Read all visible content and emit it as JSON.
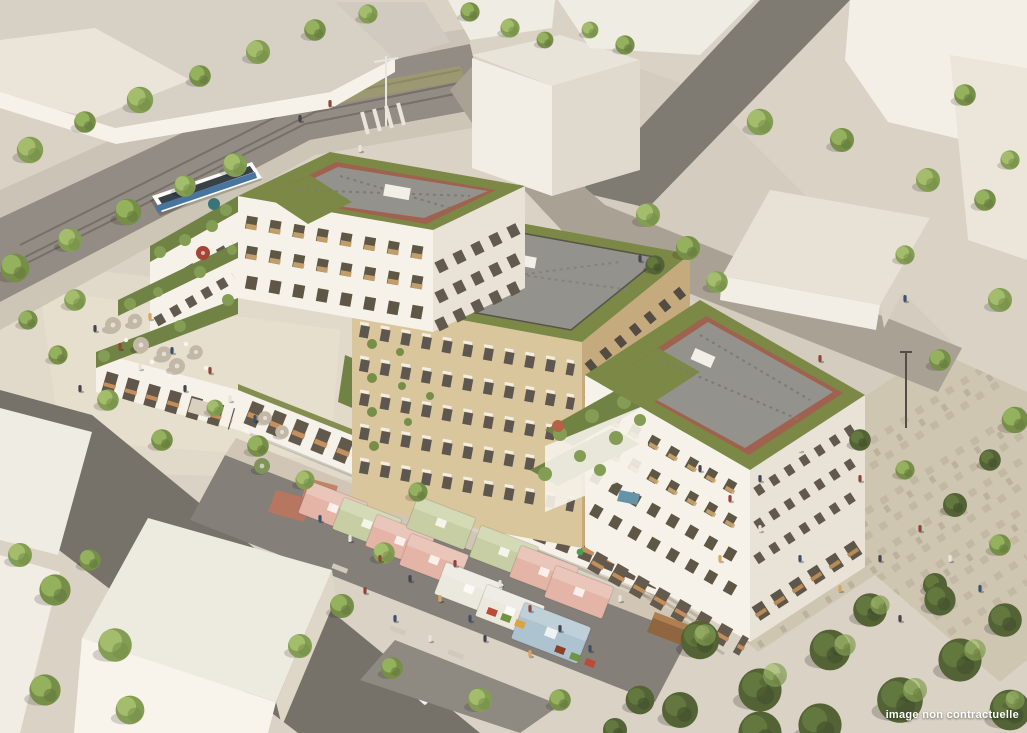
{
  "caption": {
    "text": "image non contractuelle"
  },
  "scene": {
    "description": "Aerial architectural rendering of a residential block with green roofs, rooftop terraces, a tram street, a covered market with pastel canopies, cafe terraces and pedestrian plazas lined with trees.",
    "elements": [
      "context buildings",
      "tram street with tram",
      "white residential building",
      "beige residential building",
      "green roofs with gravel decks",
      "planted courtyard garden",
      "market stall canopies",
      "cafe terrace umbrellas",
      "stone pedestrian plaza",
      "street trees",
      "dense foliage"
    ]
  },
  "colors": {
    "ground": "#d8d1c5",
    "plaza_light": "#e2dbcc",
    "plaza_stone": "#cdc4b2",
    "plaza_stripe": "#c0b6a2",
    "asphalt": "#6f6b65",
    "street_tram": "#8d8781",
    "street_ne": "#a49d92",
    "market_ground": "#7e7a74",
    "facade_white": "#f6f3ec",
    "facade_white_shadow": "#e8e2d7",
    "facade_beige": "#d8c49a",
    "facade_beige_shadow": "#c2a77b",
    "context_white": "#efece5",
    "context_roof": "#d5cfc6",
    "green_roof": "#75833f",
    "foliage_dark": "#4a5c2f",
    "foliage_mid": "#7d9a4e",
    "foliage_light": "#a2bd6a",
    "roof_gravel": "#8f8e8a",
    "roof_brick": "#9a5b48",
    "canopy_pink": "#e3b3a6",
    "canopy_sage": "#c6cda2",
    "canopy_white": "#eae8e0",
    "canopy_blue": "#a9c2d1",
    "umbrella_red": "#a33c30",
    "umbrella_teal": "#2f6f74",
    "umbrella_cafe": "#c0b6a4",
    "pool_blue": "#5d8fa6",
    "tram_blue": "#3f6f9e",
    "caption_color": "#ffffff"
  }
}
